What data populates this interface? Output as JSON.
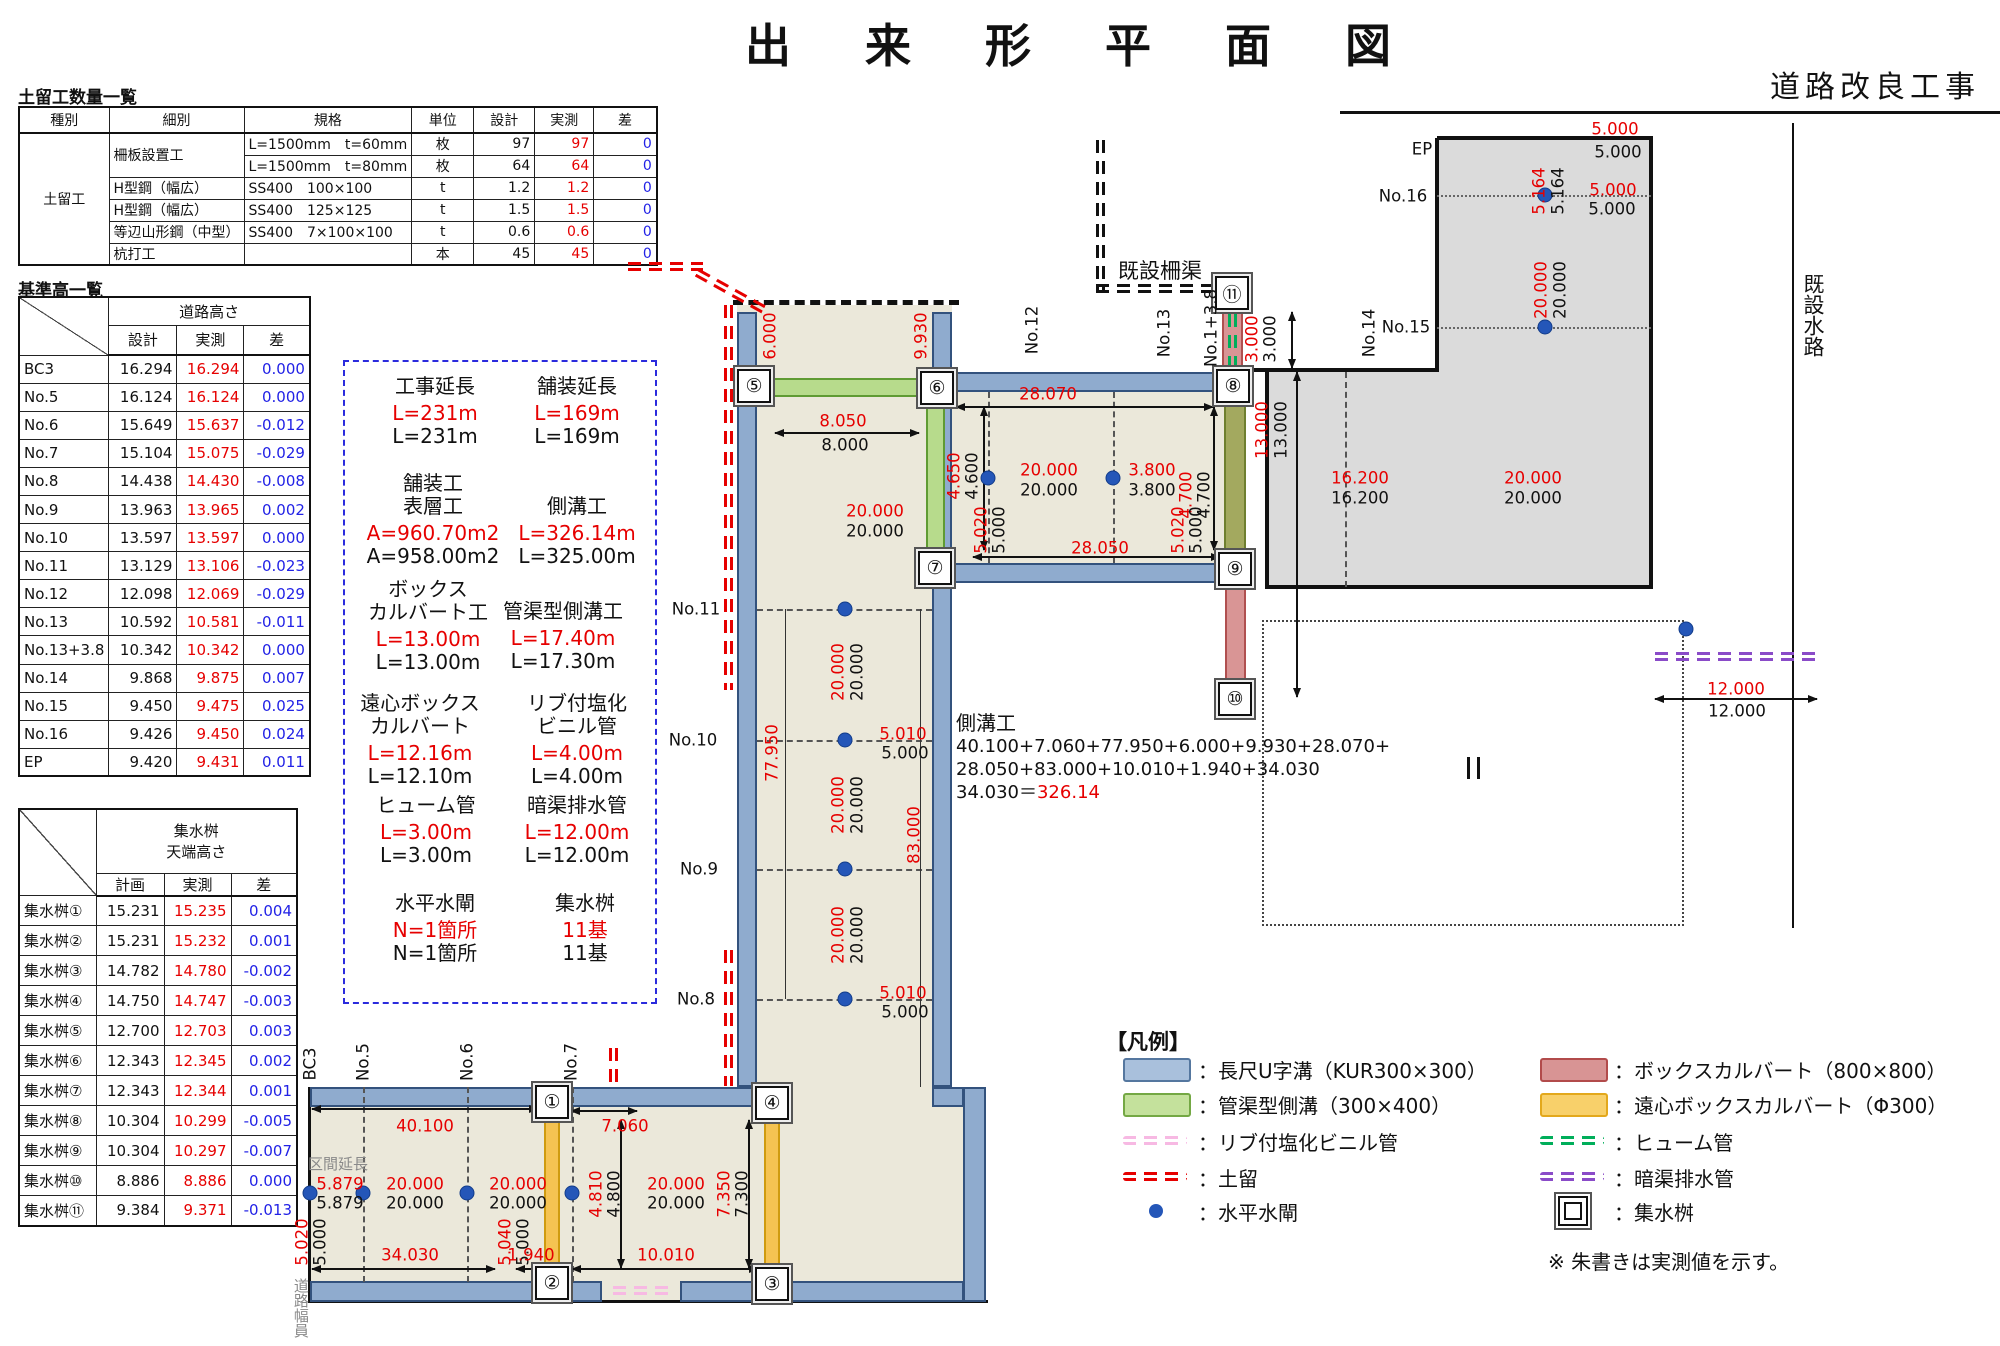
{
  "title": "出　来　形　平　面　図",
  "subtitle": "道路改良工事",
  "note": "※ 朱書きは実測値を示す。",
  "dobome_table": {
    "title": "土留工数量一覧",
    "headers": [
      "種別",
      "細別",
      "規格",
      "単位",
      "設計",
      "実測",
      "差"
    ],
    "group_label": "土留工",
    "rows": [
      {
        "saibetsu": "柵板設置工",
        "kikaku": "L=1500mm　t=60mm",
        "unit": "枚",
        "design": "97",
        "actual": "97",
        "diff": "0"
      },
      {
        "saibetsu": "",
        "kikaku": "L=1500mm　t=80mm",
        "unit": "枚",
        "design": "64",
        "actual": "64",
        "diff": "0"
      },
      {
        "saibetsu": "H型鋼（幅広）",
        "kikaku": "SS400　100×100",
        "unit": "t",
        "design": "1.2",
        "actual": "1.2",
        "diff": "0"
      },
      {
        "saibetsu": "H型鋼（幅広）",
        "kikaku": "SS400　125×125",
        "unit": "t",
        "design": "1.5",
        "actual": "1.5",
        "diff": "0"
      },
      {
        "saibetsu": "等辺山形鋼（中型）",
        "kikaku": "SS400　7×100×100",
        "unit": "t",
        "design": "0.6",
        "actual": "0.6",
        "diff": "0"
      },
      {
        "saibetsu": "杭打工",
        "kikaku": "",
        "unit": "本",
        "design": "45",
        "actual": "45",
        "diff": "0"
      }
    ]
  },
  "height_table": {
    "title": "基準高一覧",
    "section1": {
      "header": "道路高さ",
      "cols": [
        "設計",
        "実測",
        "差"
      ],
      "rows": [
        [
          "BC3",
          "16.294",
          "16.294",
          "0.000"
        ],
        [
          "No.5",
          "16.124",
          "16.124",
          "0.000"
        ],
        [
          "No.6",
          "15.649",
          "15.637",
          "-0.012"
        ],
        [
          "No.7",
          "15.104",
          "15.075",
          "-0.029"
        ],
        [
          "No.8",
          "14.438",
          "14.430",
          "-0.008"
        ],
        [
          "No.9",
          "13.963",
          "13.965",
          "0.002"
        ],
        [
          "No.10",
          "13.597",
          "13.597",
          "0.000"
        ],
        [
          "No.11",
          "13.129",
          "13.106",
          "-0.023"
        ],
        [
          "No.12",
          "12.098",
          "12.069",
          "-0.029"
        ],
        [
          "No.13",
          "10.592",
          "10.581",
          "-0.011"
        ],
        [
          "No.13+3.8",
          "10.342",
          "10.342",
          "0.000"
        ],
        [
          "No.14",
          "9.868",
          "9.875",
          "0.007"
        ],
        [
          "No.15",
          "9.450",
          "9.475",
          "0.025"
        ],
        [
          "No.16",
          "9.426",
          "9.450",
          "0.024"
        ],
        [
          "EP",
          "9.420",
          "9.431",
          "0.011"
        ]
      ]
    },
    "section2": {
      "header_line1": "集水桝",
      "header_line2": "天端高さ",
      "cols": [
        "計画",
        "実測",
        "差"
      ],
      "rows": [
        [
          "集水桝①",
          "15.231",
          "15.235",
          "0.004"
        ],
        [
          "集水桝②",
          "15.231",
          "15.232",
          "0.001"
        ],
        [
          "集水桝③",
          "14.782",
          "14.780",
          "-0.002"
        ],
        [
          "集水桝④",
          "14.750",
          "14.747",
          "-0.003"
        ],
        [
          "集水桝⑤",
          "12.700",
          "12.703",
          "0.003"
        ],
        [
          "集水桝⑥",
          "12.343",
          "12.345",
          "0.002"
        ],
        [
          "集水桝⑦",
          "12.343",
          "12.344",
          "0.001"
        ],
        [
          "集水桝⑧",
          "10.304",
          "10.299",
          "-0.005"
        ],
        [
          "集水桝⑨",
          "10.304",
          "10.297",
          "-0.007"
        ],
        [
          "集水桝⑩",
          "8.886",
          "8.886",
          "0.000"
        ],
        [
          "集水桝⑪",
          "9.384",
          "9.371",
          "-0.013"
        ]
      ]
    }
  },
  "summary_box": {
    "items": [
      {
        "lines": [
          "工事延長"
        ],
        "actual": "L=231m",
        "design": "L=231m",
        "cx": 435,
        "y": 375
      },
      {
        "lines": [
          "舗装延長"
        ],
        "actual": "L=169m",
        "design": "L=169m",
        "cx": 577,
        "y": 375
      },
      {
        "lines": [
          "舗装工",
          "表層工"
        ],
        "actual": "A=960.70m2",
        "design": "A=958.00m2",
        "cx": 433,
        "y": 472
      },
      {
        "lines": [
          "側溝工"
        ],
        "actual": "L=326.14m",
        "design": "L=325.00m",
        "cx": 577,
        "y": 495
      },
      {
        "lines": [
          "ボックス",
          "カルバート工"
        ],
        "actual": "L=13.00m",
        "design": "L=13.00m",
        "cx": 428,
        "y": 578
      },
      {
        "lines": [
          "管渠型側溝工"
        ],
        "actual": "L=17.40m",
        "design": "L=17.30m",
        "cx": 563,
        "y": 600
      },
      {
        "lines": [
          "遠心ボックス",
          "カルバート"
        ],
        "actual": "L=12.16m",
        "design": "L=12.10m",
        "cx": 420,
        "y": 692
      },
      {
        "lines": [
          "リブ付塩化",
          "ビニル管"
        ],
        "actual": "L=4.00m",
        "design": "L=4.00m",
        "cx": 577,
        "y": 692
      },
      {
        "lines": [
          "ヒューム管"
        ],
        "actual": "L=3.00m",
        "design": "L=3.00m",
        "cx": 426,
        "y": 794
      },
      {
        "lines": [
          "暗渠排水管"
        ],
        "actual": "L=12.00m",
        "design": "L=12.00m",
        "cx": 577,
        "y": 794
      },
      {
        "lines": [
          "水平水閘"
        ],
        "actual": "N=1箇所",
        "design": "N=1箇所",
        "cx": 435,
        "y": 892
      },
      {
        "lines": [
          "集水桝"
        ],
        "actual": "11基",
        "design": "11基",
        "cx": 585,
        "y": 892
      }
    ]
  },
  "sokkou_calc": {
    "title": "側溝工",
    "line1": "40.100+7.060+77.950+6.000+9.930+28.070+",
    "line2": "28.050+83.000+10.010+1.940+34.030",
    "line3_pre": "34.030＝",
    "line3_result": "326.14"
  },
  "legend": {
    "title": "【凡例】",
    "left": [
      {
        "sym": "swatch",
        "color": "#a9c0dc",
        "border": "#55779f",
        "label": "：長尺U字溝（KUR300×300）"
      },
      {
        "sym": "swatch",
        "color": "#c4e19c",
        "border": "#74a844",
        "label": "：管渠型側溝（300×400）"
      },
      {
        "sym": "dash",
        "color": "#f7b9e3",
        "label": "：リブ付塩化ビニル管"
      },
      {
        "sym": "dash",
        "color": "#e60000",
        "label": "：土留"
      },
      {
        "sym": "dot",
        "color": "#2456b8",
        "label": "：水平水閘"
      }
    ],
    "right": [
      {
        "sym": "swatch",
        "color": "#d89494",
        "border": "#b24b4b",
        "label": "：ボックスカルバート（800×800）"
      },
      {
        "sym": "swatch",
        "color": "#f8d06a",
        "border": "#e3a81c",
        "label": "：遠心ボックスカルバート（Φ300）"
      },
      {
        "sym": "dash",
        "color": "#00ae5a",
        "label": "：ヒューム管"
      },
      {
        "sym": "dash",
        "color": "#8a4bc8",
        "label": "：暗渠排水管"
      },
      {
        "sym": "basin",
        "label": "：集水桝"
      }
    ]
  },
  "drawing": {
    "nodes": [
      {
        "n": "①",
        "x": 552,
        "y": 1102
      },
      {
        "n": "②",
        "x": 552,
        "y": 1283
      },
      {
        "n": "③",
        "x": 772,
        "y": 1284
      },
      {
        "n": "④",
        "x": 772,
        "y": 1103
      },
      {
        "n": "⑤",
        "x": 754,
        "y": 386
      },
      {
        "n": "⑥",
        "x": 937,
        "y": 388
      },
      {
        "n": "⑦",
        "x": 935,
        "y": 568
      },
      {
        "n": "⑧",
        "x": 1233,
        "y": 386
      },
      {
        "n": "⑨",
        "x": 1235,
        "y": 569
      },
      {
        "n": "⑩",
        "x": 1235,
        "y": 699
      },
      {
        "n": "⑪",
        "x": 1232,
        "y": 293
      }
    ],
    "water_gates": [
      [
        310,
        1193
      ],
      [
        363,
        1193
      ],
      [
        467,
        1193
      ],
      [
        572,
        1193
      ],
      [
        845,
        609
      ],
      [
        845,
        740
      ],
      [
        845,
        869
      ],
      [
        845,
        999
      ],
      [
        988,
        478
      ],
      [
        1113,
        478
      ],
      [
        1545,
        195
      ],
      [
        1545,
        327
      ],
      [
        1686,
        629
      ]
    ],
    "annotations": [
      {
        "t": "5.000",
        "x": 1615,
        "y": 129,
        "c": "r"
      },
      {
        "t": "5.000",
        "x": 1618,
        "y": 152,
        "c": "k"
      },
      {
        "t": "5.164",
        "x": 1539,
        "y": 191,
        "c": "r",
        "r": 1
      },
      {
        "t": "5.164",
        "x": 1558,
        "y": 191,
        "c": "k",
        "r": 1
      },
      {
        "t": "5.000",
        "x": 1613,
        "y": 190,
        "c": "r"
      },
      {
        "t": "5.000",
        "x": 1612,
        "y": 209,
        "c": "k"
      },
      {
        "t": "20.000",
        "x": 1541,
        "y": 290,
        "c": "r",
        "r": 1
      },
      {
        "t": "20.000",
        "x": 1560,
        "y": 290,
        "c": "k",
        "r": 1
      },
      {
        "t": "EP",
        "x": 1422,
        "y": 149,
        "c": "k"
      },
      {
        "t": "No.16",
        "x": 1403,
        "y": 196,
        "c": "k"
      },
      {
        "t": "No.15",
        "x": 1406,
        "y": 327,
        "c": "k"
      },
      {
        "t": "20.000",
        "x": 1533,
        "y": 478,
        "c": "r"
      },
      {
        "t": "20.000",
        "x": 1533,
        "y": 498,
        "c": "k"
      },
      {
        "t": "16.200",
        "x": 1360,
        "y": 478,
        "c": "r"
      },
      {
        "t": "16.200",
        "x": 1360,
        "y": 498,
        "c": "k"
      },
      {
        "t": "No.14",
        "x": 1369,
        "y": 333,
        "c": "k",
        "r": 1
      },
      {
        "t": "既設水路",
        "x": 1813,
        "y": 315,
        "c": "k",
        "r": 2,
        "s": 21
      },
      {
        "t": "28.070",
        "x": 1048,
        "y": 394,
        "c": "r"
      },
      {
        "t": "28.050",
        "x": 1100,
        "y": 548,
        "c": "r"
      },
      {
        "t": "20.000",
        "x": 1049,
        "y": 470,
        "c": "r"
      },
      {
        "t": "20.000",
        "x": 1049,
        "y": 490,
        "c": "k"
      },
      {
        "t": "3.800",
        "x": 1152,
        "y": 470,
        "c": "r"
      },
      {
        "t": "3.800",
        "x": 1152,
        "y": 490,
        "c": "k"
      },
      {
        "t": "4.650",
        "x": 954,
        "y": 476,
        "c": "r",
        "r": 1
      },
      {
        "t": "4.600",
        "x": 972,
        "y": 476,
        "c": "k",
        "r": 1
      },
      {
        "t": "4.700",
        "x": 1186,
        "y": 495,
        "c": "r",
        "r": 1
      },
      {
        "t": "4.700",
        "x": 1204,
        "y": 495,
        "c": "k",
        "r": 1
      },
      {
        "t": "5.020",
        "x": 981,
        "y": 530,
        "c": "r",
        "r": 1
      },
      {
        "t": "5.000",
        "x": 999,
        "y": 530,
        "c": "k",
        "r": 1
      },
      {
        "t": "5.020",
        "x": 1178,
        "y": 530,
        "c": "r",
        "r": 1
      },
      {
        "t": "5.000",
        "x": 1196,
        "y": 530,
        "c": "k",
        "r": 1
      },
      {
        "t": "No.12",
        "x": 1032,
        "y": 330,
        "c": "k",
        "r": 1
      },
      {
        "t": "No.13",
        "x": 1164,
        "y": 333,
        "c": "k",
        "r": 1
      },
      {
        "t": "No.1+3.8",
        "x": 1211,
        "y": 328,
        "c": "k",
        "r": 1
      },
      {
        "t": "3.000",
        "x": 1252,
        "y": 339,
        "c": "r",
        "r": 1
      },
      {
        "t": "3.000",
        "x": 1270,
        "y": 339,
        "c": "k",
        "r": 1
      },
      {
        "t": "13.000",
        "x": 1262,
        "y": 430,
        "c": "r",
        "r": 1
      },
      {
        "t": "13.000",
        "x": 1281,
        "y": 430,
        "c": "k",
        "r": 1
      },
      {
        "t": "既設柵渠",
        "x": 1160,
        "y": 271,
        "c": "k",
        "s": 21
      },
      {
        "t": "8.050",
        "x": 843,
        "y": 421,
        "c": "r"
      },
      {
        "t": "8.000",
        "x": 845,
        "y": 445,
        "c": "k"
      },
      {
        "t": "6.000",
        "x": 770,
        "y": 336,
        "c": "r",
        "r": 1
      },
      {
        "t": "9.930",
        "x": 921,
        "y": 336,
        "c": "r",
        "r": 1
      },
      {
        "t": "20.000",
        "x": 875,
        "y": 511,
        "c": "r"
      },
      {
        "t": "20.000",
        "x": 875,
        "y": 531,
        "c": "k"
      },
      {
        "t": "No.11",
        "x": 696,
        "y": 609,
        "c": "k"
      },
      {
        "t": "No.10",
        "x": 693,
        "y": 740,
        "c": "k"
      },
      {
        "t": "No.9",
        "x": 699,
        "y": 869,
        "c": "k"
      },
      {
        "t": "No.8",
        "x": 696,
        "y": 999,
        "c": "k"
      },
      {
        "t": "20.000",
        "x": 838,
        "y": 672,
        "c": "r",
        "r": 1
      },
      {
        "t": "20.000",
        "x": 857,
        "y": 672,
        "c": "k",
        "r": 1
      },
      {
        "t": "20.000",
        "x": 838,
        "y": 805,
        "c": "r",
        "r": 1
      },
      {
        "t": "20.000",
        "x": 857,
        "y": 805,
        "c": "k",
        "r": 1
      },
      {
        "t": "20.000",
        "x": 838,
        "y": 935,
        "c": "r",
        "r": 1
      },
      {
        "t": "20.000",
        "x": 857,
        "y": 935,
        "c": "k",
        "r": 1
      },
      {
        "t": "5.010",
        "x": 903,
        "y": 734,
        "c": "r"
      },
      {
        "t": "5.000",
        "x": 905,
        "y": 753,
        "c": "k"
      },
      {
        "t": "5.010",
        "x": 903,
        "y": 993,
        "c": "r"
      },
      {
        "t": "5.000",
        "x": 905,
        "y": 1012,
        "c": "k"
      },
      {
        "t": "77.950",
        "x": 772,
        "y": 753,
        "c": "r",
        "r": 1
      },
      {
        "t": "83.000",
        "x": 914,
        "y": 835,
        "c": "r",
        "r": 1
      },
      {
        "t": "BC3",
        "x": 310,
        "y": 1064,
        "c": "k",
        "r": 1
      },
      {
        "t": "No.5",
        "x": 363,
        "y": 1062,
        "c": "k",
        "r": 1
      },
      {
        "t": "No.6",
        "x": 467,
        "y": 1062,
        "c": "k",
        "r": 1
      },
      {
        "t": "No.7",
        "x": 571,
        "y": 1062,
        "c": "k",
        "r": 1
      },
      {
        "t": "40.100",
        "x": 425,
        "y": 1126,
        "c": "r"
      },
      {
        "t": "7.060",
        "x": 625,
        "y": 1126,
        "c": "r"
      },
      {
        "t": "区間延長",
        "x": 338,
        "y": 1165,
        "c": "g",
        "s": 15
      },
      {
        "t": "5.879",
        "x": 340,
        "y": 1184,
        "c": "r"
      },
      {
        "t": "5.879",
        "x": 340,
        "y": 1203,
        "c": "k"
      },
      {
        "t": "20.000",
        "x": 415,
        "y": 1184,
        "c": "r"
      },
      {
        "t": "20.000",
        "x": 415,
        "y": 1203,
        "c": "k"
      },
      {
        "t": "20.000",
        "x": 518,
        "y": 1184,
        "c": "r"
      },
      {
        "t": "20.000",
        "x": 518,
        "y": 1203,
        "c": "k"
      },
      {
        "t": "20.000",
        "x": 676,
        "y": 1184,
        "c": "r"
      },
      {
        "t": "20.000",
        "x": 676,
        "y": 1203,
        "c": "k"
      },
      {
        "t": "4.810",
        "x": 596,
        "y": 1194,
        "c": "r",
        "r": 1
      },
      {
        "t": "4.800",
        "x": 614,
        "y": 1194,
        "c": "k",
        "r": 1
      },
      {
        "t": "7.350",
        "x": 724,
        "y": 1194,
        "c": "r",
        "r": 1
      },
      {
        "t": "7.300",
        "x": 742,
        "y": 1194,
        "c": "k",
        "r": 1
      },
      {
        "t": "5.020",
        "x": 302,
        "y": 1242,
        "c": "r",
        "r": 1
      },
      {
        "t": "5.000",
        "x": 320,
        "y": 1242,
        "c": "k",
        "r": 1
      },
      {
        "t": "34.030",
        "x": 410,
        "y": 1255,
        "c": "r"
      },
      {
        "t": "5.040",
        "x": 505,
        "y": 1242,
        "c": "r",
        "r": 1
      },
      {
        "t": "5.000",
        "x": 523,
        "y": 1242,
        "c": "k",
        "r": 1
      },
      {
        "t": "1.940",
        "x": 531,
        "y": 1255,
        "c": "r"
      },
      {
        "t": "10.010",
        "x": 666,
        "y": 1255,
        "c": "r"
      },
      {
        "t": "道路幅員",
        "x": 300,
        "y": 1308,
        "c": "g",
        "r": 2,
        "s": 15
      },
      {
        "t": "12.000",
        "x": 1736,
        "y": 689,
        "c": "r"
      },
      {
        "t": "12.000",
        "x": 1737,
        "y": 711,
        "c": "k"
      }
    ]
  },
  "colors": {
    "actual_red": "#e60000",
    "diff_blue": "#2222e6",
    "u_channel_blue": "#8fabce",
    "pipe_channel_green": "#b7db8c",
    "box_culvert_pink": "#d99595",
    "centrifugal_box_yellow": "#f5c352",
    "road_beige": "#ebe8da",
    "paved_gray": "#dbdbdb"
  }
}
